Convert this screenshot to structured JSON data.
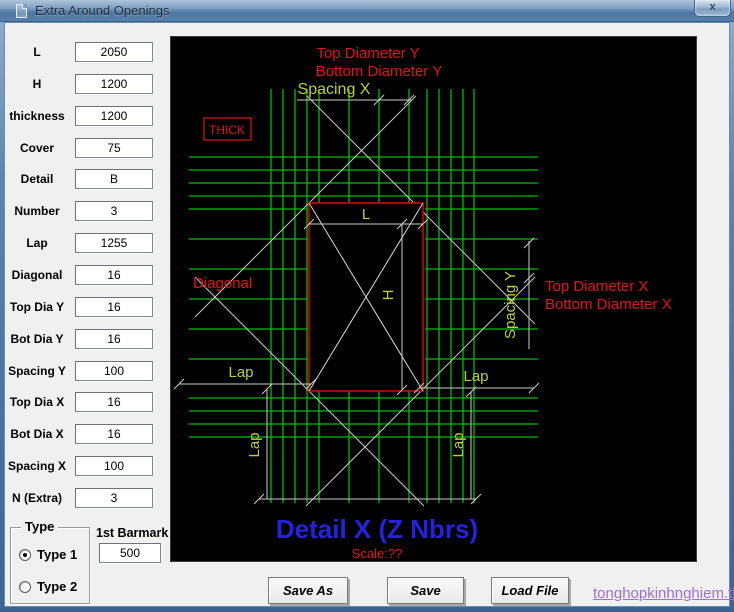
{
  "window": {
    "title": "Extra Around Openings",
    "close_glyph": "x"
  },
  "fields": [
    {
      "label": "L",
      "value": "2050"
    },
    {
      "label": "H",
      "value": "1200"
    },
    {
      "label": "thickness",
      "value": "1200"
    },
    {
      "label": "Cover",
      "value": "75"
    },
    {
      "label": "Detail",
      "value": "B"
    },
    {
      "label": "Number",
      "value": "3"
    },
    {
      "label": "Lap",
      "value": "1255"
    },
    {
      "label": "Diagonal",
      "value": "16"
    },
    {
      "label": "Top Dia Y",
      "value": "16"
    },
    {
      "label": "Bot Dia Y",
      "value": "16"
    },
    {
      "label": "Spacing Y",
      "value": "100"
    },
    {
      "label": "Top Dia X",
      "value": "16"
    },
    {
      "label": "Bot Dia X",
      "value": "16"
    },
    {
      "label": "Spacing X",
      "value": "100"
    },
    {
      "label": "N (Extra)",
      "value": "3"
    }
  ],
  "type_group": {
    "caption": "Type",
    "option1": "Type 1",
    "option2": "Type 2",
    "selected": "Type 1"
  },
  "barmark": {
    "label": "1st Barmark",
    "value": "500"
  },
  "buttons": {
    "save_as": "Save As",
    "save": "Save",
    "load_file": "Load File"
  },
  "watermark": "tonghopkinhnghiem.tk",
  "drawing": {
    "labels": {
      "top_diameter_y": "Top Diameter Y",
      "bottom_diameter_y": "Bottom Diameter Y",
      "spacing_x": "Spacing X",
      "thick": "THICK",
      "diagonal": "Diagonal",
      "l": "L",
      "h": "H",
      "lap_left": "Lap",
      "lap_right": "Lap",
      "lap_bottom_left": "Lap",
      "lap_bottom_right": "Lap",
      "spacing_y": "Spacing Y",
      "top_diameter_x": "Top Diameter X",
      "bottom_diameter_x": "Bottom Diameter X",
      "title": "Detail X (Z Nbrs)",
      "scale": "Scale:??"
    },
    "colors": {
      "background": "#000000",
      "rebar_green": "#00bd00",
      "dim_label_green": "#bdd12e",
      "annotation_red": "#e41414",
      "opening_red": "#d40000",
      "dim_line_white": "#cccccc",
      "title_blue": "#2222e0"
    }
  }
}
